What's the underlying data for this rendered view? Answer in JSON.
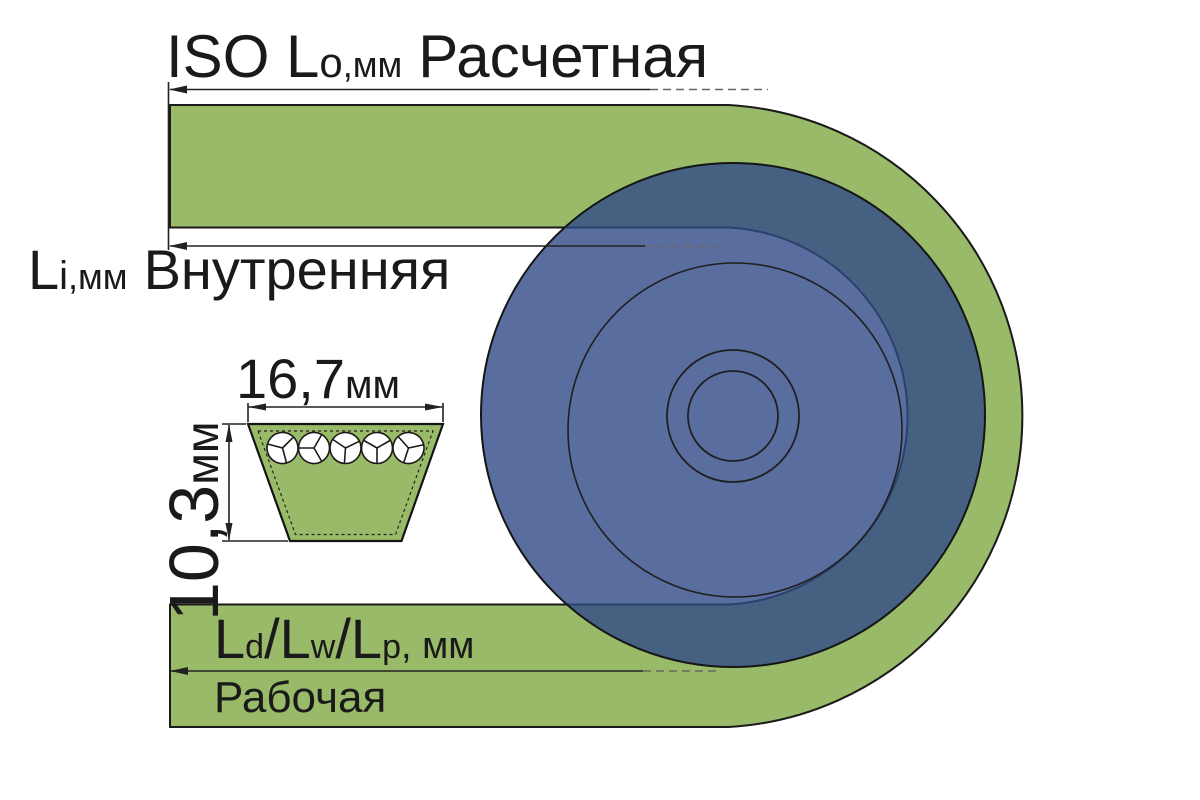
{
  "diagram": {
    "dim_outer": {
      "prefix": "ISO L",
      "sub": "o",
      "units": ",мм",
      "name": "Расчетная"
    },
    "dim_inner": {
      "prefix": "L",
      "sub": "i",
      "units": ",мм",
      "name": "Внутренняя"
    },
    "dim_working": {
      "m1": "L",
      "s1": "d",
      "sl1": "/",
      "m2": "L",
      "s2": "w",
      "sl2": "/",
      "m3": "L",
      "s3": "p",
      "units": ", мм",
      "name": "Рабочая"
    },
    "cross_section": {
      "width_value": "16,7",
      "width_units": "мм",
      "height_value": "10,3",
      "height_units": "мм",
      "cord_count": 5
    },
    "colors": {
      "belt": "#99ba68",
      "pulley": "rgba(47,74,134,0.8)",
      "outline": "#1a1a1a",
      "dim_line": "#222222",
      "dash_line": "#666666",
      "text": "#1a1a1a",
      "cord_fill": "#ffffff"
    }
  }
}
